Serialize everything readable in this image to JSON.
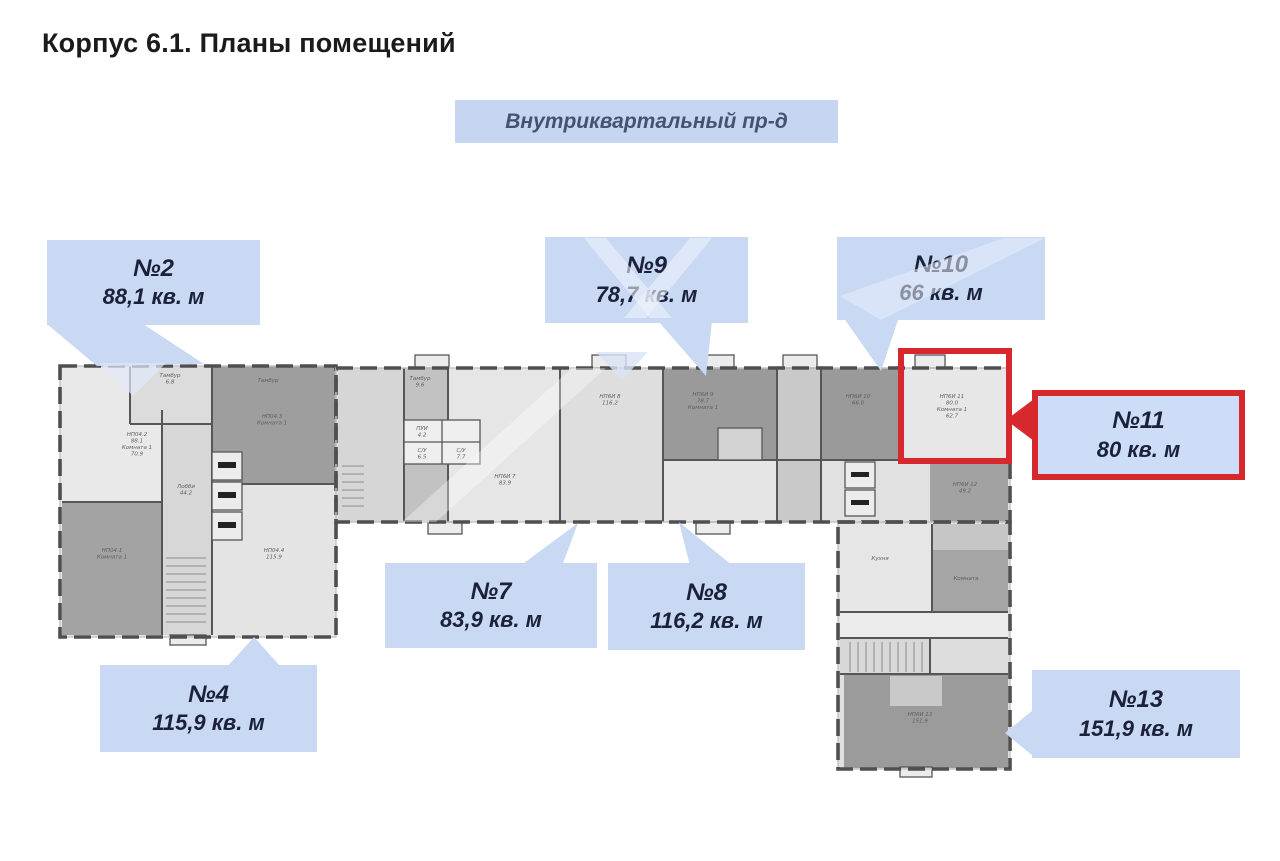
{
  "page": {
    "title": "Корпус 6.1. Планы помещений"
  },
  "street_sign": {
    "label": "Внутриквартальный пр-д"
  },
  "colors": {
    "callout_bg": "#c9d8f3",
    "callout_text": "#1a2138",
    "highlight_red": "#d7282d",
    "street_sign_bg": "#c6d5f1",
    "street_sign_text": "#44536e",
    "wall": "#4f4f4f"
  },
  "units": [
    {
      "number": "№2",
      "area": "88,1 кв. м",
      "highlighted": false
    },
    {
      "number": "№9",
      "area": "78,7 кв. м",
      "highlighted": false
    },
    {
      "number": "№10",
      "area": "66 кв. м",
      "highlighted": false
    },
    {
      "number": "№11",
      "area": "80 кв. м",
      "highlighted": true
    },
    {
      "number": "№7",
      "area": "83,9 кв. м",
      "highlighted": false
    },
    {
      "number": "№8",
      "area": "116,2 кв. м",
      "highlighted": false
    },
    {
      "number": "№4",
      "area": "115,9 кв. м",
      "highlighted": false
    },
    {
      "number": "№13",
      "area": "151,9 кв. м",
      "highlighted": false
    }
  ],
  "plan": {
    "room_labels": [
      {
        "x": 137,
        "y": 436,
        "lines": [
          "НП04.2",
          "88.1",
          "Комната 1",
          "70.9"
        ]
      },
      {
        "x": 170,
        "y": 377,
        "lines": [
          "Тамбур",
          "6.8"
        ]
      },
      {
        "x": 268,
        "y": 382,
        "lines": [
          "Тамбур"
        ]
      },
      {
        "x": 272,
        "y": 418,
        "lines": [
          "НП04.3",
          "Комната 1"
        ]
      },
      {
        "x": 112,
        "y": 552,
        "lines": [
          "НП04.1",
          "Комната 1"
        ]
      },
      {
        "x": 274,
        "y": 552,
        "lines": [
          "НП04.4",
          "115.9"
        ]
      },
      {
        "x": 186,
        "y": 488,
        "lines": [
          "Лобби",
          "44.2"
        ]
      },
      {
        "x": 420,
        "y": 380,
        "lines": [
          "Тамбур",
          "9.6"
        ]
      },
      {
        "x": 422,
        "y": 430,
        "lines": [
          "ПУИ",
          "4.2"
        ]
      },
      {
        "x": 422,
        "y": 452,
        "lines": [
          "С/У",
          "6.5"
        ]
      },
      {
        "x": 461,
        "y": 452,
        "lines": [
          "С/У",
          "7.7"
        ]
      },
      {
        "x": 610,
        "y": 398,
        "lines": [
          "НП6И 8",
          "116.2"
        ]
      },
      {
        "x": 505,
        "y": 478,
        "lines": [
          "НП6И 7",
          "83.9"
        ]
      },
      {
        "x": 703,
        "y": 396,
        "lines": [
          "НП6И 9",
          "78.7",
          "Комната 1"
        ]
      },
      {
        "x": 858,
        "y": 398,
        "lines": [
          "НП6И 10",
          "66.0"
        ]
      },
      {
        "x": 952,
        "y": 398,
        "lines": [
          "НП6И 11",
          "80.0",
          "Комната 1",
          "62.7"
        ]
      },
      {
        "x": 965,
        "y": 486,
        "lines": [
          "НП6И 12",
          "49.2"
        ]
      },
      {
        "x": 880,
        "y": 560,
        "lines": [
          "Кухня"
        ]
      },
      {
        "x": 966,
        "y": 580,
        "lines": [
          "Комната"
        ]
      },
      {
        "x": 920,
        "y": 716,
        "lines": [
          "НП6И 13",
          "151.9"
        ]
      }
    ]
  }
}
